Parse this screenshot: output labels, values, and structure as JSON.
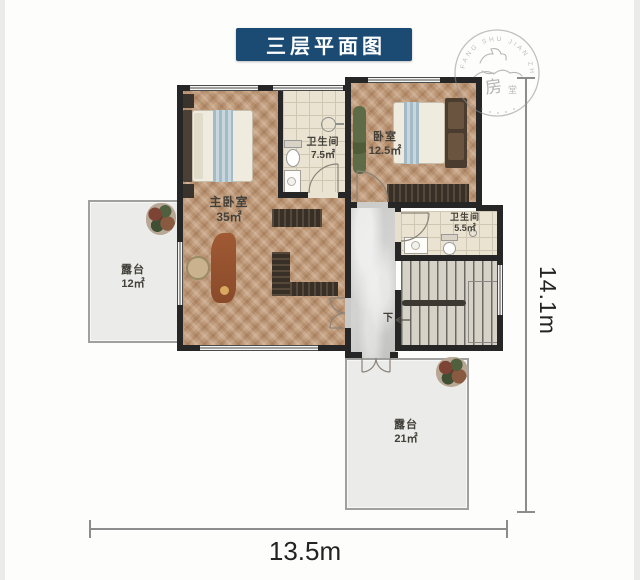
{
  "title": "三层平面图",
  "seal": {
    "arc_text": "FANG SHU JIAN ZHU",
    "char_primary": "房",
    "char_secondary": "堂"
  },
  "rooms": {
    "master_bedroom": {
      "name": "主卧室",
      "area": "35㎡"
    },
    "bathroom_large": {
      "name": "卫生间",
      "area": "7.5㎡"
    },
    "bedroom": {
      "name": "卧室",
      "area": "12.5㎡"
    },
    "bathroom_small": {
      "name": "卫生间",
      "area": "5.5㎡"
    },
    "terrace_left": {
      "name": "露台",
      "area": "12㎡"
    },
    "terrace_bottom": {
      "name": "露台",
      "area": "21㎡"
    }
  },
  "stairs": {
    "down_label": "下"
  },
  "dimensions": {
    "width": "13.5m",
    "height": "14.1m"
  },
  "colors": {
    "banner_blue": "#1b4a72",
    "wall": "#262626",
    "wood_floor": "#c09a78",
    "tile_floor": "#eae3d1",
    "marble_floor": "#cccccb",
    "terrace_floor": "#ebebe9"
  }
}
